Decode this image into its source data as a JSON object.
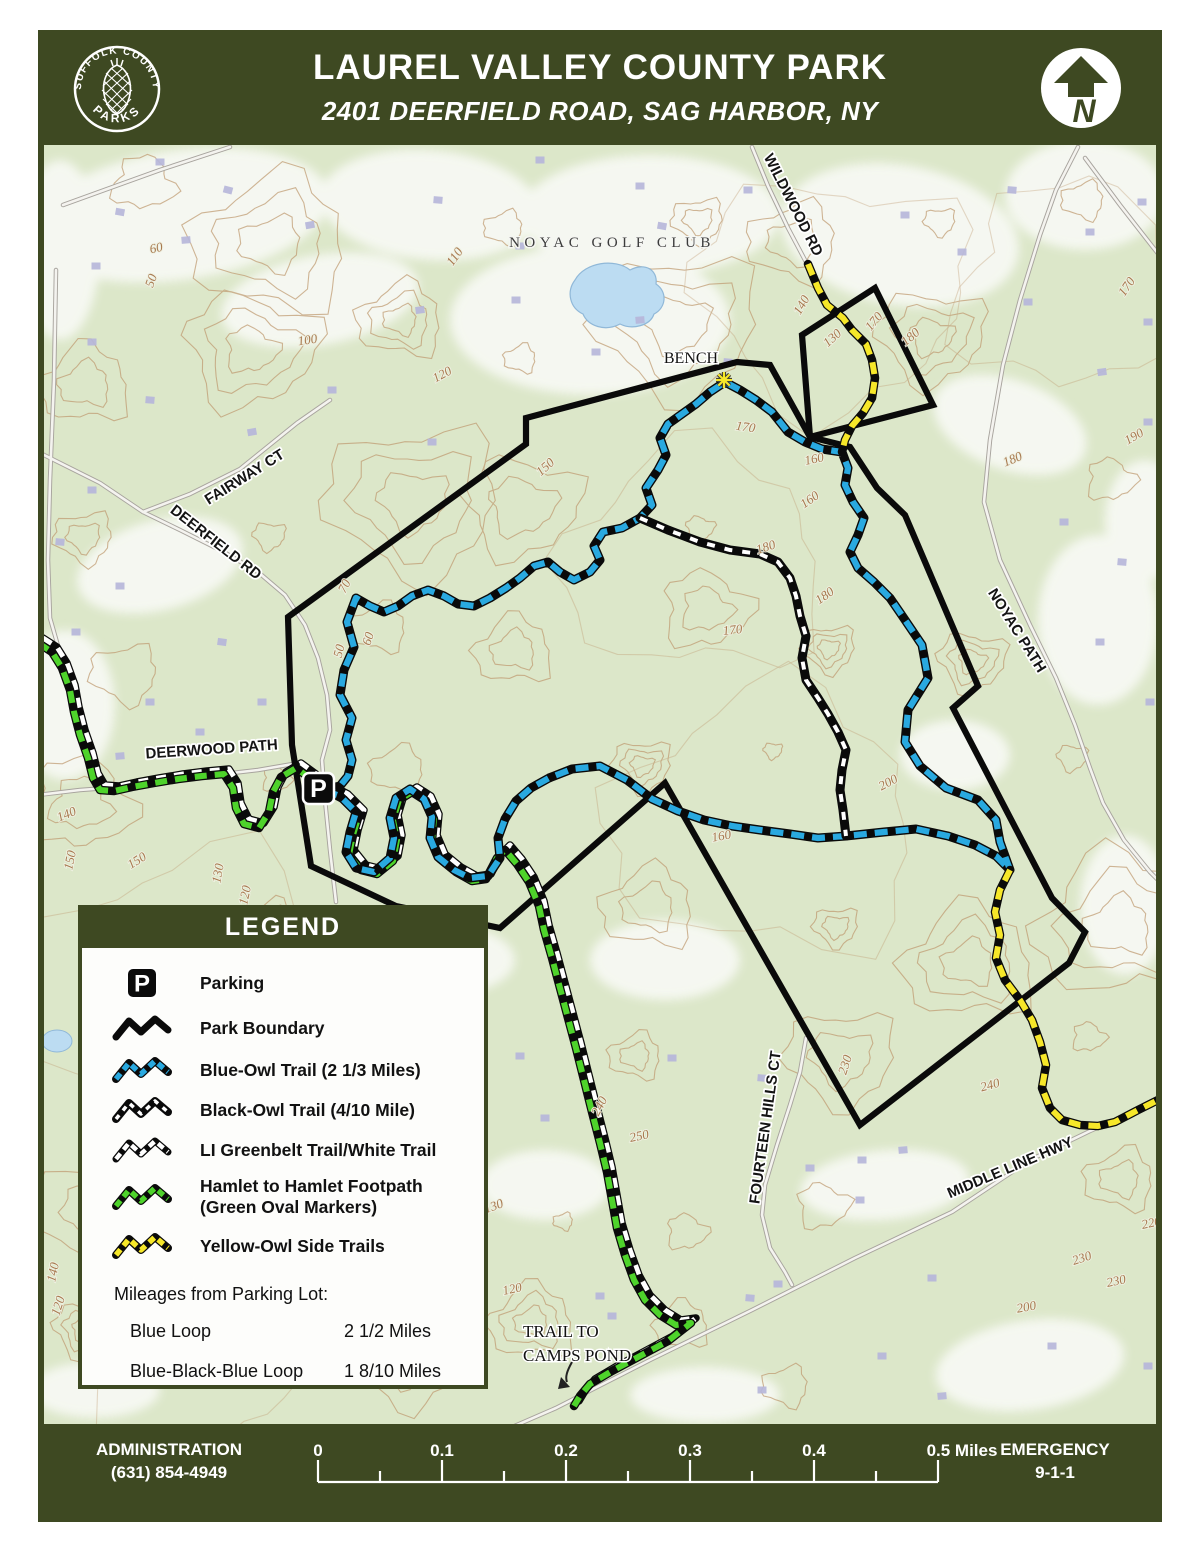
{
  "header": {
    "title": "LAUREL VALLEY COUNTY PARK",
    "subtitle": "2401 DEERFIELD ROAD, SAG HARBOR, NY",
    "logo_top": "SUFFOLK COUNTY",
    "logo_bottom": "PARKS",
    "north_label": "N"
  },
  "legend": {
    "title": "LEGEND",
    "items": [
      {
        "swatch": "parking",
        "label": "Parking"
      },
      {
        "swatch": "boundary",
        "label": "Park Boundary"
      },
      {
        "swatch": "blue",
        "label": "Blue-Owl Trail (2 1/3 Miles)"
      },
      {
        "swatch": "black",
        "label": "Black-Owl Trail (4/10 Mile)"
      },
      {
        "swatch": "white",
        "label": "LI Greenbelt Trail/White Trail"
      },
      {
        "swatch": "green",
        "label": "Hamlet to Hamlet Footpath",
        "label2": "(Green Oval Markers)"
      },
      {
        "swatch": "yellow",
        "label": "Yellow-Owl Side Trails"
      }
    ],
    "mileages_title": "Mileages from Parking Lot:",
    "mileages": [
      {
        "label": "Blue Loop",
        "value": "2 1/2 Miles"
      },
      {
        "label": "Blue-Black-Blue Loop",
        "value": "1 8/10 Miles"
      }
    ]
  },
  "footer": {
    "admin_label": "ADMINISTRATION",
    "admin_phone": "(631) 854-4949",
    "emergency_label": "EMERGENCY",
    "emergency_value": "9-1-1",
    "scale_ticks": [
      "0",
      "0.1",
      "0.2",
      "0.3",
      "0.4"
    ],
    "scale_end": "0.5 Miles"
  },
  "map": {
    "parking_marker": "P",
    "road_labels": [
      {
        "text": "WILDWOOD RD",
        "x": 789,
        "y": 207,
        "rot": 63
      },
      {
        "text": "FAIRWAY CT",
        "x": 247,
        "y": 481,
        "rot": -32
      },
      {
        "text": "DEERFIELD RD",
        "x": 213,
        "y": 546,
        "rot": 38
      },
      {
        "text": "DEERWOOD PATH",
        "x": 212,
        "y": 754,
        "rot": -4
      },
      {
        "text": "NOYAC PATH",
        "x": 1013,
        "y": 633,
        "rot": 58
      },
      {
        "text": "FOURTEEN HILLS CT",
        "x": 770,
        "y": 1128,
        "rot": -82
      },
      {
        "text": "MIDDLE LINE HWY",
        "x": 1012,
        "y": 1172,
        "rot": -23
      }
    ],
    "place_labels": [
      {
        "text": "NOYAC GOLF CLUB",
        "x": 612,
        "y": 247,
        "kind": "golf"
      },
      {
        "text": "BENCH",
        "x": 691,
        "y": 363,
        "kind": "poi"
      },
      {
        "text": "TRAIL TO",
        "x": 523,
        "y": 1337,
        "kind": "note"
      },
      {
        "text": "CAMPS POND",
        "x": 523,
        "y": 1361,
        "kind": "note"
      }
    ],
    "contour_labels": [
      {
        "text": "60",
        "x": 157,
        "y": 252,
        "rot": -12
      },
      {
        "text": "50",
        "x": 155,
        "y": 282,
        "rot": -70
      },
      {
        "text": "110",
        "x": 458,
        "y": 259,
        "rot": -55
      },
      {
        "text": "100",
        "x": 308,
        "y": 344,
        "rot": -8
      },
      {
        "text": "120",
        "x": 444,
        "y": 378,
        "rot": -28
      },
      {
        "text": "140",
        "x": 805,
        "y": 307,
        "rot": -60
      },
      {
        "text": "130",
        "x": 835,
        "y": 341,
        "rot": -42
      },
      {
        "text": "170",
        "x": 877,
        "y": 324,
        "rot": -50
      },
      {
        "text": "180",
        "x": 913,
        "y": 340,
        "rot": -40
      },
      {
        "text": "160",
        "x": 815,
        "y": 463,
        "rot": -12
      },
      {
        "text": "170",
        "x": 1130,
        "y": 289,
        "rot": -55
      },
      {
        "text": "190",
        "x": 1136,
        "y": 440,
        "rot": -30
      },
      {
        "text": "180",
        "x": 1014,
        "y": 463,
        "rot": -22
      },
      {
        "text": "150",
        "x": 548,
        "y": 470,
        "rot": -42
      },
      {
        "text": "170",
        "x": 745,
        "y": 431,
        "rot": 8
      },
      {
        "text": "160",
        "x": 812,
        "y": 503,
        "rot": -35
      },
      {
        "text": "180",
        "x": 767,
        "y": 551,
        "rot": -18
      },
      {
        "text": "180",
        "x": 827,
        "y": 599,
        "rot": -35
      },
      {
        "text": "170",
        "x": 733,
        "y": 634,
        "rot": -6
      },
      {
        "text": "70",
        "x": 348,
        "y": 588,
        "rot": -62
      },
      {
        "text": "60",
        "x": 372,
        "y": 640,
        "rot": -72
      },
      {
        "text": "50",
        "x": 343,
        "y": 652,
        "rot": -75
      },
      {
        "text": "140",
        "x": 68,
        "y": 818,
        "rot": -22
      },
      {
        "text": "150",
        "x": 74,
        "y": 861,
        "rot": -78
      },
      {
        "text": "150",
        "x": 139,
        "y": 864,
        "rot": -32
      },
      {
        "text": "130",
        "x": 222,
        "y": 874,
        "rot": -80
      },
      {
        "text": "120",
        "x": 249,
        "y": 896,
        "rot": -78
      },
      {
        "text": "160",
        "x": 722,
        "y": 840,
        "rot": -10
      },
      {
        "text": "200",
        "x": 890,
        "y": 786,
        "rot": -28
      },
      {
        "text": "230",
        "x": 849,
        "y": 1066,
        "rot": -72
      },
      {
        "text": "240",
        "x": 603,
        "y": 1108,
        "rot": -62
      },
      {
        "text": "250",
        "x": 640,
        "y": 1140,
        "rot": -12
      },
      {
        "text": "240",
        "x": 991,
        "y": 1089,
        "rot": -15
      },
      {
        "text": "200",
        "x": 1024,
        "y": 1167,
        "rot": -8
      },
      {
        "text": "220",
        "x": 1152,
        "y": 1227,
        "rot": -12
      },
      {
        "text": "230",
        "x": 1083,
        "y": 1262,
        "rot": -18
      },
      {
        "text": "230",
        "x": 1117,
        "y": 1285,
        "rot": -12
      },
      {
        "text": "200",
        "x": 1027,
        "y": 1311,
        "rot": -10
      },
      {
        "text": "130",
        "x": 495,
        "y": 1210,
        "rot": -20
      },
      {
        "text": "140",
        "x": 57,
        "y": 1273,
        "rot": -78
      },
      {
        "text": "120",
        "x": 62,
        "y": 1307,
        "rot": -72
      },
      {
        "text": "120",
        "x": 513,
        "y": 1293,
        "rot": -12
      }
    ],
    "trails": [
      {
        "name": "Park Boundary",
        "color": "#0a0a0a",
        "style": "solid"
      },
      {
        "name": "Blue-Owl Trail",
        "color": "#29a9e0",
        "style": "dashed"
      },
      {
        "name": "Black-Owl Trail",
        "color": "#111111",
        "style": "white-dashed"
      },
      {
        "name": "LI Greenbelt Trail/White Trail",
        "color": "#ffffff",
        "style": "dashed"
      },
      {
        "name": "Hamlet to Hamlet Footpath",
        "color": "#4ed32b",
        "style": "dashed"
      },
      {
        "name": "Yellow-Owl Side Trails",
        "color": "#f6e729",
        "style": "dashed"
      }
    ]
  },
  "colors": {
    "frame_green": "#3e4922",
    "map_bg": "#dce7c9",
    "contour": "#bf9a70",
    "road_casing": "#a8a49e",
    "road_fill": "#f4f3ef",
    "water": "#bcdcf2",
    "building": "#b7b7da",
    "blue": "#29a9e0",
    "green": "#4ed32b",
    "yellow": "#f6e729",
    "black": "#111111",
    "white": "#ffffff"
  }
}
